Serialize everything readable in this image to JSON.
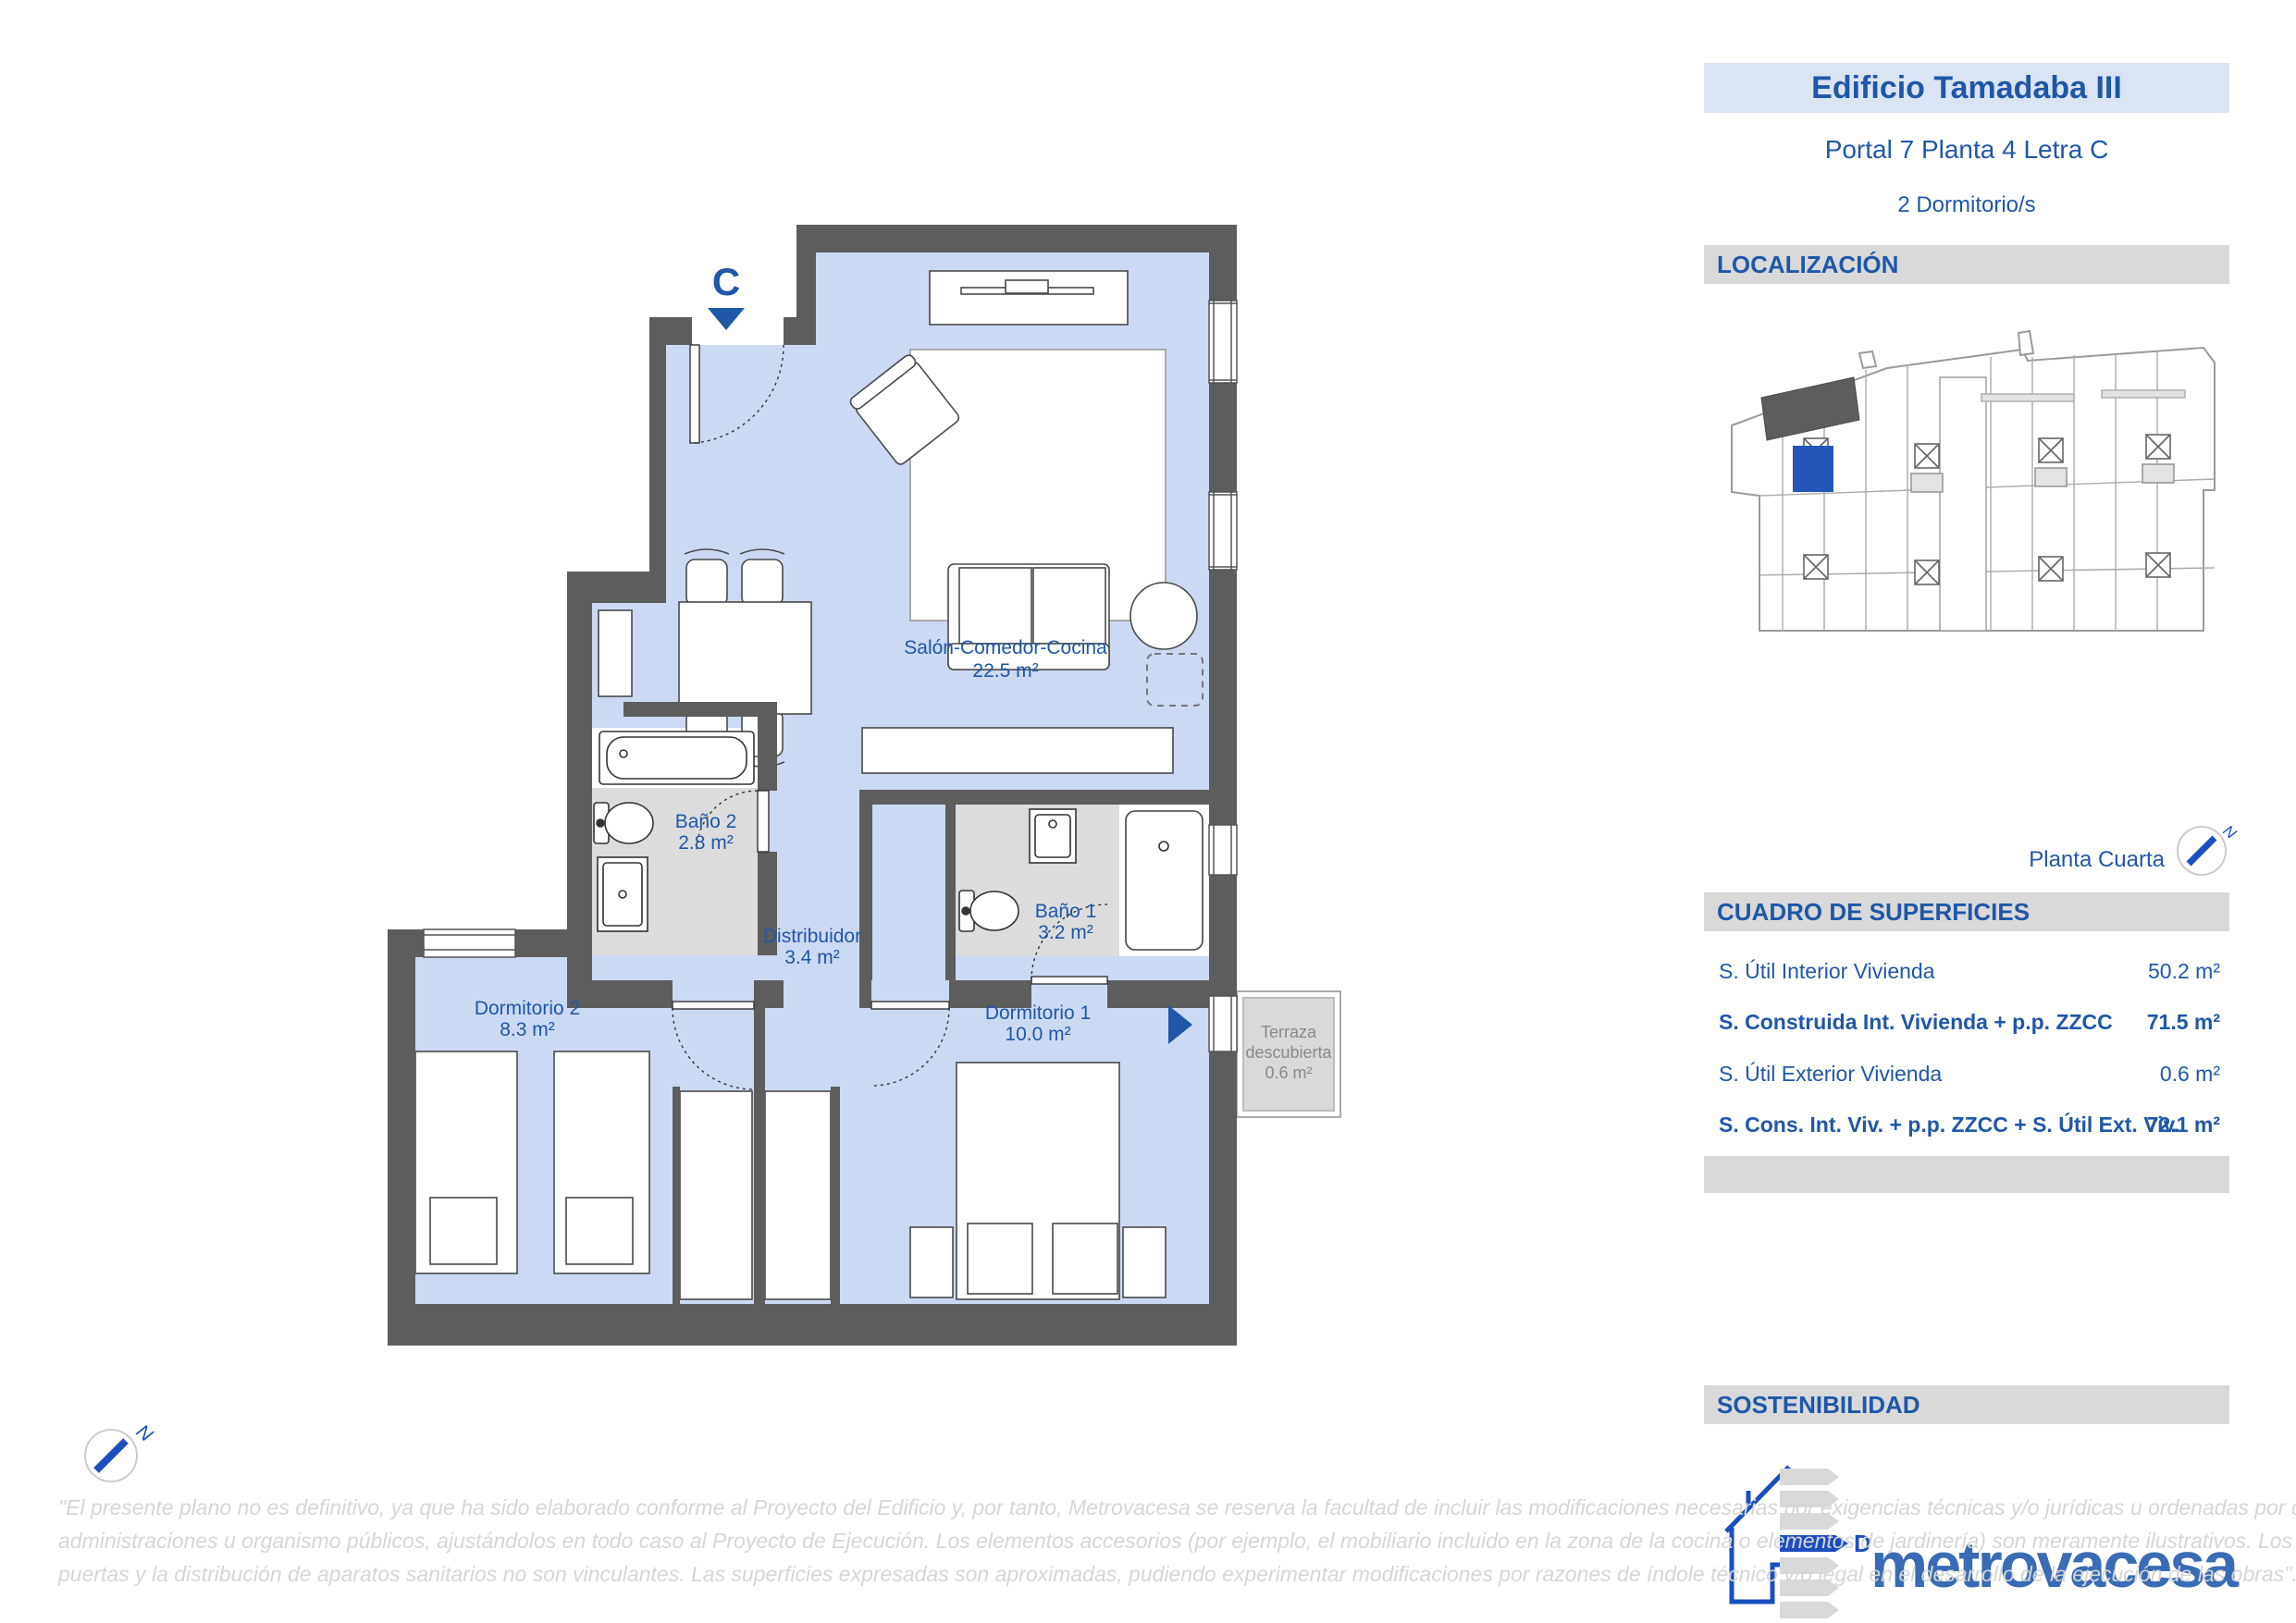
{
  "colors": {
    "accent_blue": "#2057a7",
    "title_band_bg": "#dbe4f4",
    "section_band_bg": "#d9d9d9",
    "wall": "#5d5d5d",
    "room_fill": "#ccd9f2",
    "bath_fill": "#dcdcdc",
    "terrace_fill": "#d9d9d9",
    "brand_blue": "#3a6bb5",
    "highlight_unit_blue": "#2456b8"
  },
  "panel": {
    "title": "Edificio Tamadaba III",
    "subtitle": "Portal 7  Planta 4  Letra C",
    "bedrooms": "2  Dormitorio/s",
    "localizacion_title": "LOCALIZACIÓN",
    "floor_name": "Planta Cuarta",
    "north_label": "N",
    "superficies": {
      "title": "CUADRO DE SUPERFICIES",
      "rows": [
        {
          "label": "S. Útil Interior Vivienda",
          "value": "50.2 m²"
        },
        {
          "label": "S. Construida Int. Vivienda + p.p. ZZCC",
          "value": "71.5 m²"
        },
        {
          "label": "S. Útil Exterior Vivienda",
          "value": "0.6 m²"
        },
        {
          "label": "S. Cons. Int. Viv. + p.p. ZZCC + S. Útil Ext. Viv.",
          "value": "72.1 m²"
        }
      ]
    },
    "sostenibilidad_title": "SOSTENIBILIDAD",
    "energy_rating": "D",
    "brand": "metrovacesa"
  },
  "plan": {
    "entrance_letter": "C",
    "north_label": "N",
    "rooms": {
      "salon": {
        "name": "Salón-Comedor-Cocina",
        "area": "22.5 m²"
      },
      "bano2": {
        "name": "Baño 2",
        "area": "2.8 m²"
      },
      "bano1": {
        "name": "Baño 1",
        "area": "3.2 m²"
      },
      "distribuidor": {
        "name": "Distribuidor",
        "area": "3.4 m²"
      },
      "dormitorio2": {
        "name": "Dormitorio 2",
        "area": "8.3 m²"
      },
      "dormitorio1": {
        "name": "Dormitorio 1",
        "area": "10.0 m²"
      },
      "terraza": {
        "line1": "Terraza",
        "line2": "descubierta",
        "area": "0.6 m²"
      }
    }
  },
  "disclaimer": {
    "lines": [
      "\"El presente plano no es definitivo, ya que ha sido elaborado conforme al Proyecto del Edificio y, por tanto, Metrovacesa se reserva la facultad de incluir las modificaciones necesarias por exigencias técnicas y/o jurídicas u ordenadas por cualesquiera",
      "administraciones u organismo públicos, ajustándolos en todo caso al Proyecto de Ejecución. Los elementos accesorios (por ejemplo, el mobiliario incluido en la zona de la cocina o elementos de jardinería) son meramente ilustrativos. Los giros de",
      "puertas y la distribución de aparatos sanitarios no son vinculantes. Las superficies expresadas son aproximadas, pudiendo experimentar modificaciones por razones de índole técnico y/o legal en el desarrollo de la ejecución de las obras\"."
    ]
  }
}
